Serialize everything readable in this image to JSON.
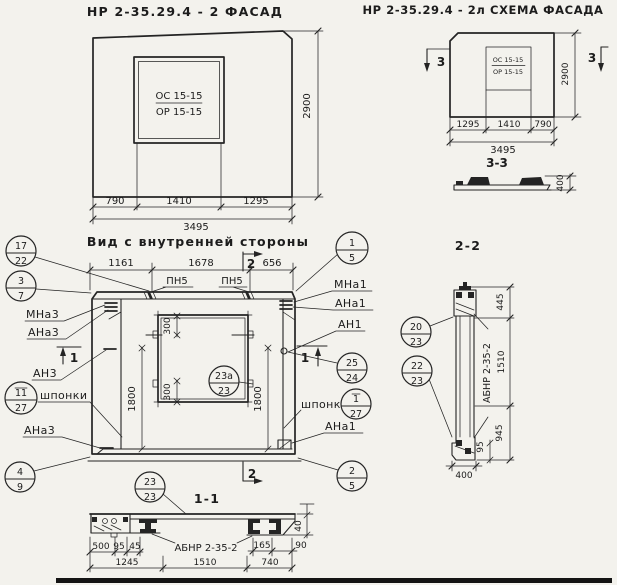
{
  "facade": {
    "title": "НР 2-35.29.4 - 2 ФАСАД",
    "window_mark_top": "ОС 15-15",
    "window_mark_bottom": "ОР 15-15",
    "dim_left": "790",
    "dim_mid": "1410",
    "dim_right": "1295",
    "dim_total": "3495",
    "dim_height": "2900"
  },
  "schema": {
    "title": "НР 2-35.29.4 - 2л СХЕМА ФАСАДА",
    "window_mark_top": "ОС 15-15",
    "window_mark_bottom": "ОР 15-15",
    "dim_left": "1295",
    "dim_mid": "1410",
    "dim_right": "790",
    "dim_total": "3495",
    "dim_height": "2900",
    "section_mark": "3",
    "section_title": "3-3",
    "section_height": "400"
  },
  "inner": {
    "title": "Вид с внутренней стороны",
    "dim_top_left": "1161",
    "dim_top_mid": "1678",
    "dim_top_right": "656",
    "pn_label": "ПН5",
    "section1_mark": "1",
    "section2_mark": "2",
    "dim_side": "1800",
    "dim_corner": "300",
    "label_mna3": "МНа3",
    "label_ana3": "АНа3",
    "label_an3": "АН3",
    "label_shponki_left": "шпонки",
    "label_ana3_bottom": "АНа3",
    "label_mna1": "МНа1",
    "label_ana1": "АНа1",
    "label_an1": "АН1",
    "label_shponki_right": "шпонки",
    "label_ana1_bottom": "АНа1",
    "callouts": {
      "c17": "17",
      "c22": "22",
      "c3": "3",
      "c7": "7",
      "c11": "11",
      "c27": "27",
      "c4": "4",
      "c9": "9",
      "c1": "1",
      "c5": "5",
      "c25": "25",
      "c24": "24",
      "c1r": "1",
      "c27r": "27",
      "c2": "2",
      "c5r": "5",
      "c23a": "23а",
      "c23": "23"
    }
  },
  "section22": {
    "title": "2-2",
    "callout_20": "20",
    "callout_20b": "23",
    "callout_22": "22",
    "callout_22b": "23",
    "beam_label": "АБНР 2-35-2",
    "dim_top": "445",
    "dim_mid": "1510",
    "dim_bottom": "945",
    "dim_small": "95",
    "dim_width": "400"
  },
  "section11": {
    "title": "1-1",
    "callout_top": "23",
    "callout_bottom": "23",
    "beam_label": "АБНР 2-35-2",
    "dim_500": "500",
    "dim_95": "95",
    "dim_45": "45",
    "dim_165": "165",
    "dim_90": "90",
    "dim_1245": "1245",
    "dim_1510": "1510",
    "dim_740": "740",
    "dim_40": "40"
  }
}
